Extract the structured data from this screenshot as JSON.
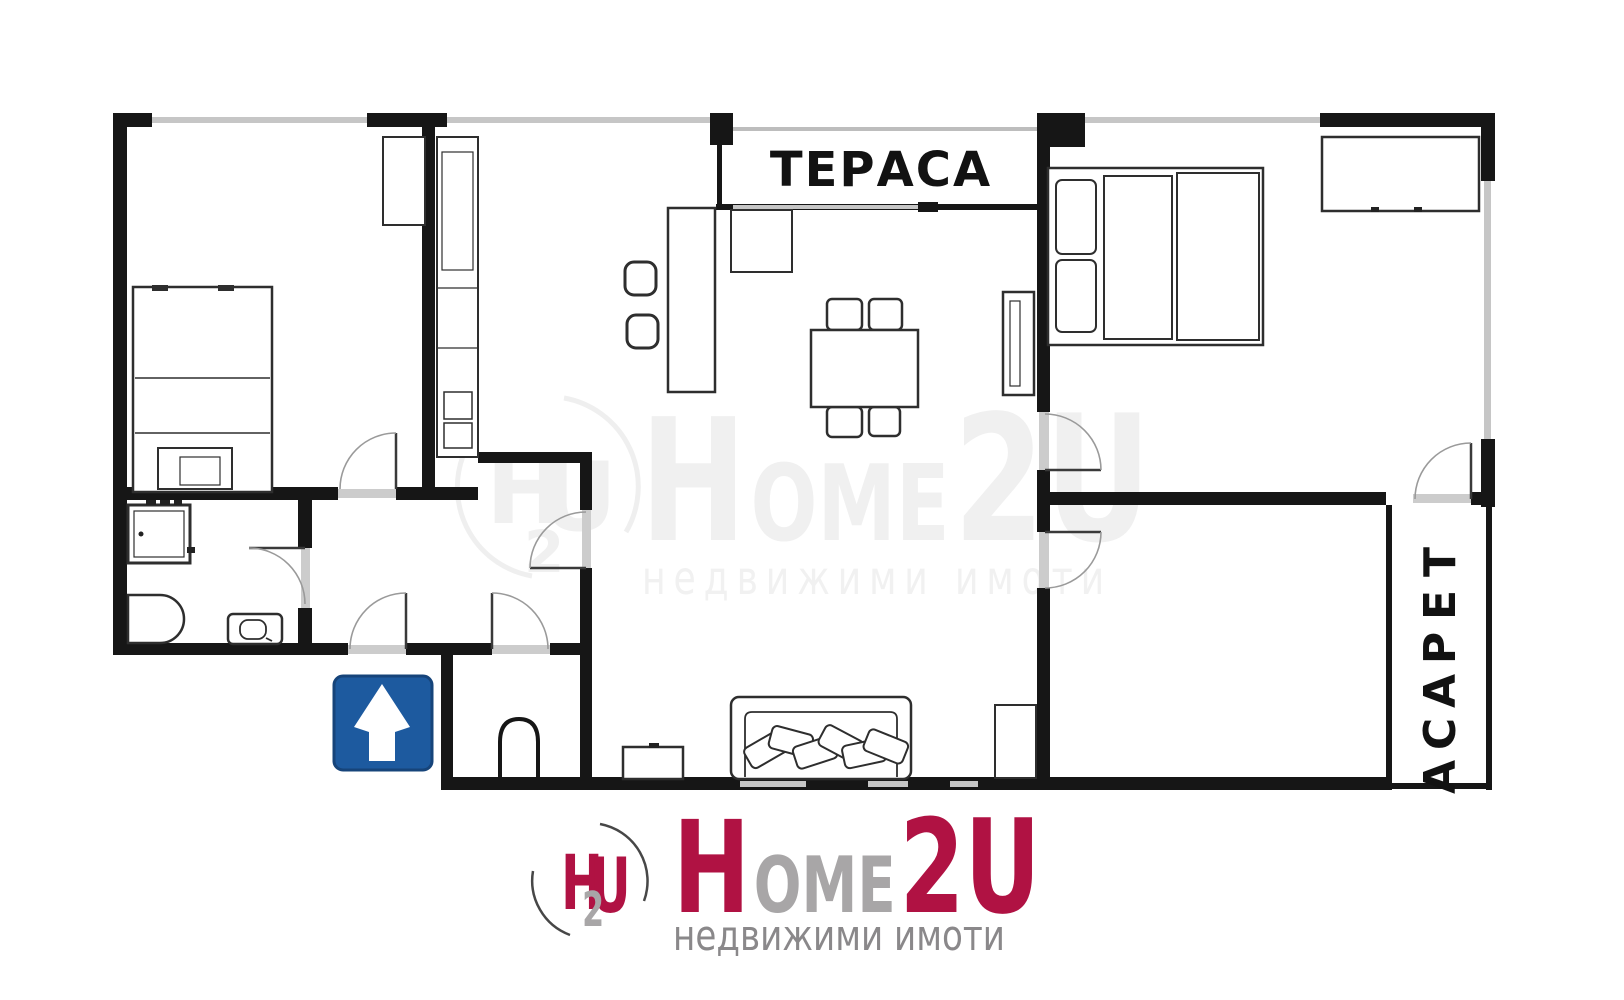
{
  "floor_plan": {
    "terrace_top_label": "ТЕРАСА",
    "terrace_right_letters": [
      "Т",
      "Е",
      "Р",
      "А",
      "С",
      "А"
    ]
  },
  "watermark": {
    "mark_h": "H",
    "mark_u": "U",
    "mark_2": "2",
    "word_h": "H",
    "word_ome": "OME",
    "word_2u": "2U",
    "tagline": "недвижими имоти"
  },
  "logo": {
    "mark_h": "H",
    "mark_u": "U",
    "mark_2": "2",
    "word_h": "H",
    "word_ome": "OME",
    "word_2u": "2U",
    "tagline": "недвижими имоти"
  },
  "sign": {
    "name": "one-way-arrow-sign"
  },
  "colors": {
    "wall_black": "#161616",
    "window_gray": "#c6c6c6",
    "brand_red": "#b01243",
    "brand_gray": "#a8a6a7",
    "tagline_gray": "#8a888a",
    "sign_blue": "#1d5a9f",
    "sign_border": "#16447a",
    "watermark_gray": "#f0f0f0"
  }
}
